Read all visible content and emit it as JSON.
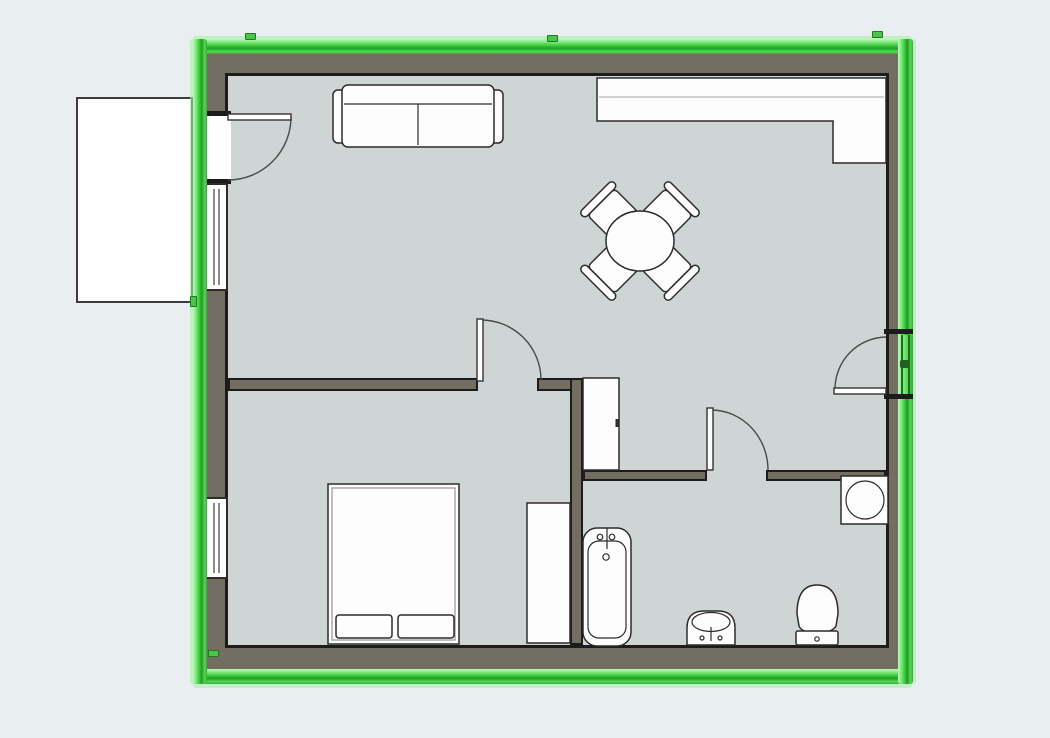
{
  "canvas": {
    "background": "#e9eef1",
    "floor_color": "#cfd5d4",
    "wall_color": "#736e61",
    "wall_edge_color": "#1c1c1c",
    "selection_color": "#3fcf3f",
    "selection_dark": "#259b25",
    "selection_light": "#8fee8f",
    "selection_glow": "#c4f2c4",
    "furniture_color": "#fdfdfd",
    "outline_color": "#2c2c2c"
  },
  "floorplan": {
    "view": "2d-top-down",
    "selected_element": "exterior-wall-loop",
    "selection_state": "selected (green highlight around all exterior walls)",
    "exterior_features": [
      {
        "name": "balcony-slab",
        "side": "left-outside"
      },
      {
        "name": "entrance-door",
        "side": "left-wall",
        "swing": "into-living-room"
      },
      {
        "name": "window",
        "side": "left-wall-living-room"
      },
      {
        "name": "window",
        "side": "left-wall-bedroom"
      },
      {
        "name": "glazed-balcony-door",
        "side": "right-wall",
        "swing": "into-living-room"
      }
    ],
    "interior_doors": [
      {
        "name": "bedroom-door",
        "wall": "living-bedroom-partition"
      },
      {
        "name": "bathroom-door",
        "wall": "living-bathroom-partition"
      }
    ],
    "furniture": [
      {
        "name": "sofa",
        "room": "living-room"
      },
      {
        "name": "kitchen-counter-l-shaped",
        "room": "living-room"
      },
      {
        "name": "round-dining-table",
        "room": "living-room"
      },
      {
        "name": "dining-chairs",
        "count": 4,
        "room": "living-room"
      },
      {
        "name": "tall-cabinet",
        "room": "living-room"
      },
      {
        "name": "double-bed-with-two-pillows",
        "room": "bedroom"
      },
      {
        "name": "wardrobe",
        "room": "bedroom"
      },
      {
        "name": "bathtub",
        "room": "bathroom"
      },
      {
        "name": "washbasin",
        "room": "bathroom"
      },
      {
        "name": "toilet",
        "room": "bathroom"
      },
      {
        "name": "washing-machine",
        "room": "bathroom"
      }
    ]
  }
}
